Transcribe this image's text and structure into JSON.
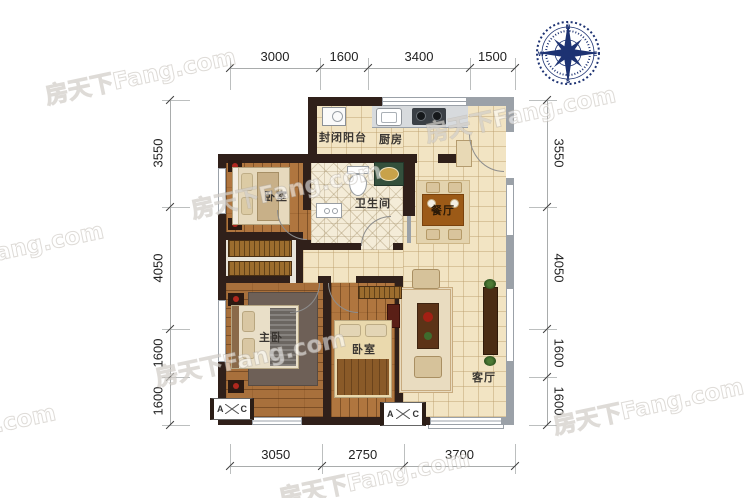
{
  "plan": {
    "rooms": {
      "balcony": "封闭阳台",
      "kitchen": "厨房",
      "bathroom": "卫生间",
      "bedroom_top": "卧室",
      "dining": "餐厅",
      "master_bedroom": "主卧",
      "bedroom_bottom": "卧室",
      "living": "客厅"
    },
    "ac_marker": {
      "left": "A",
      "right": "C"
    }
  },
  "dimensions": {
    "top": [
      "3000",
      "1600",
      "3400",
      "1500"
    ],
    "bottom": [
      "3050",
      "2750",
      "3700"
    ],
    "left": [
      "3550",
      "4050",
      "1600",
      "1600"
    ],
    "right": [
      "3550",
      "4050",
      "1600",
      "1600"
    ]
  },
  "compass": {
    "north": "N",
    "east": "E",
    "south": "S",
    "west": "W"
  },
  "watermark": {
    "text": "房天下Fang.com"
  },
  "colors": {
    "wall_dark": "#30201a",
    "wall_gray": "#9ba1a8",
    "wood": "#b0763f",
    "tile": "#f2e4c3",
    "compass_navy": "#1d3272"
  }
}
